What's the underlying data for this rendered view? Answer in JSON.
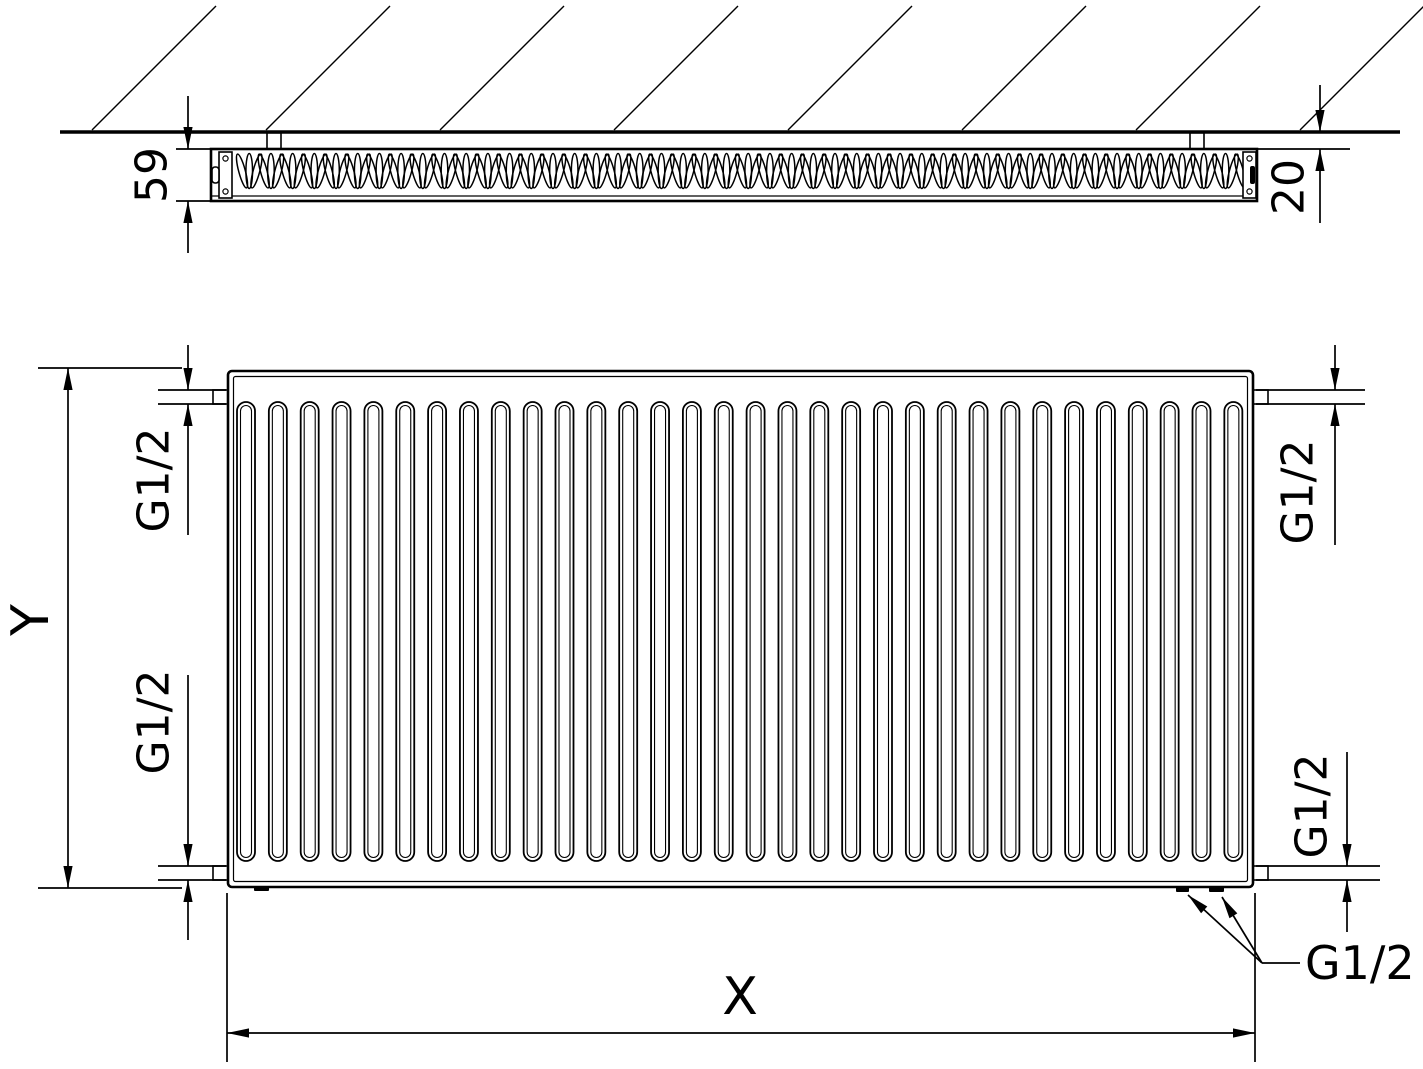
{
  "colors": {
    "line": "#000000",
    "background": "#ffffff"
  },
  "top_view": {
    "depth_dim": "59",
    "wall_gap_dim": "20",
    "fin_count": 139,
    "bracket_count": 2
  },
  "front_view": {
    "height_dim": "Y",
    "width_dim": "X",
    "channel_count": 32,
    "connections": {
      "top_left": "G1/2",
      "top_right": "G1/2",
      "bottom_left": "G1/2",
      "bottom_right": "G1/2",
      "bottom_outlets_leader": "G1/2"
    }
  }
}
